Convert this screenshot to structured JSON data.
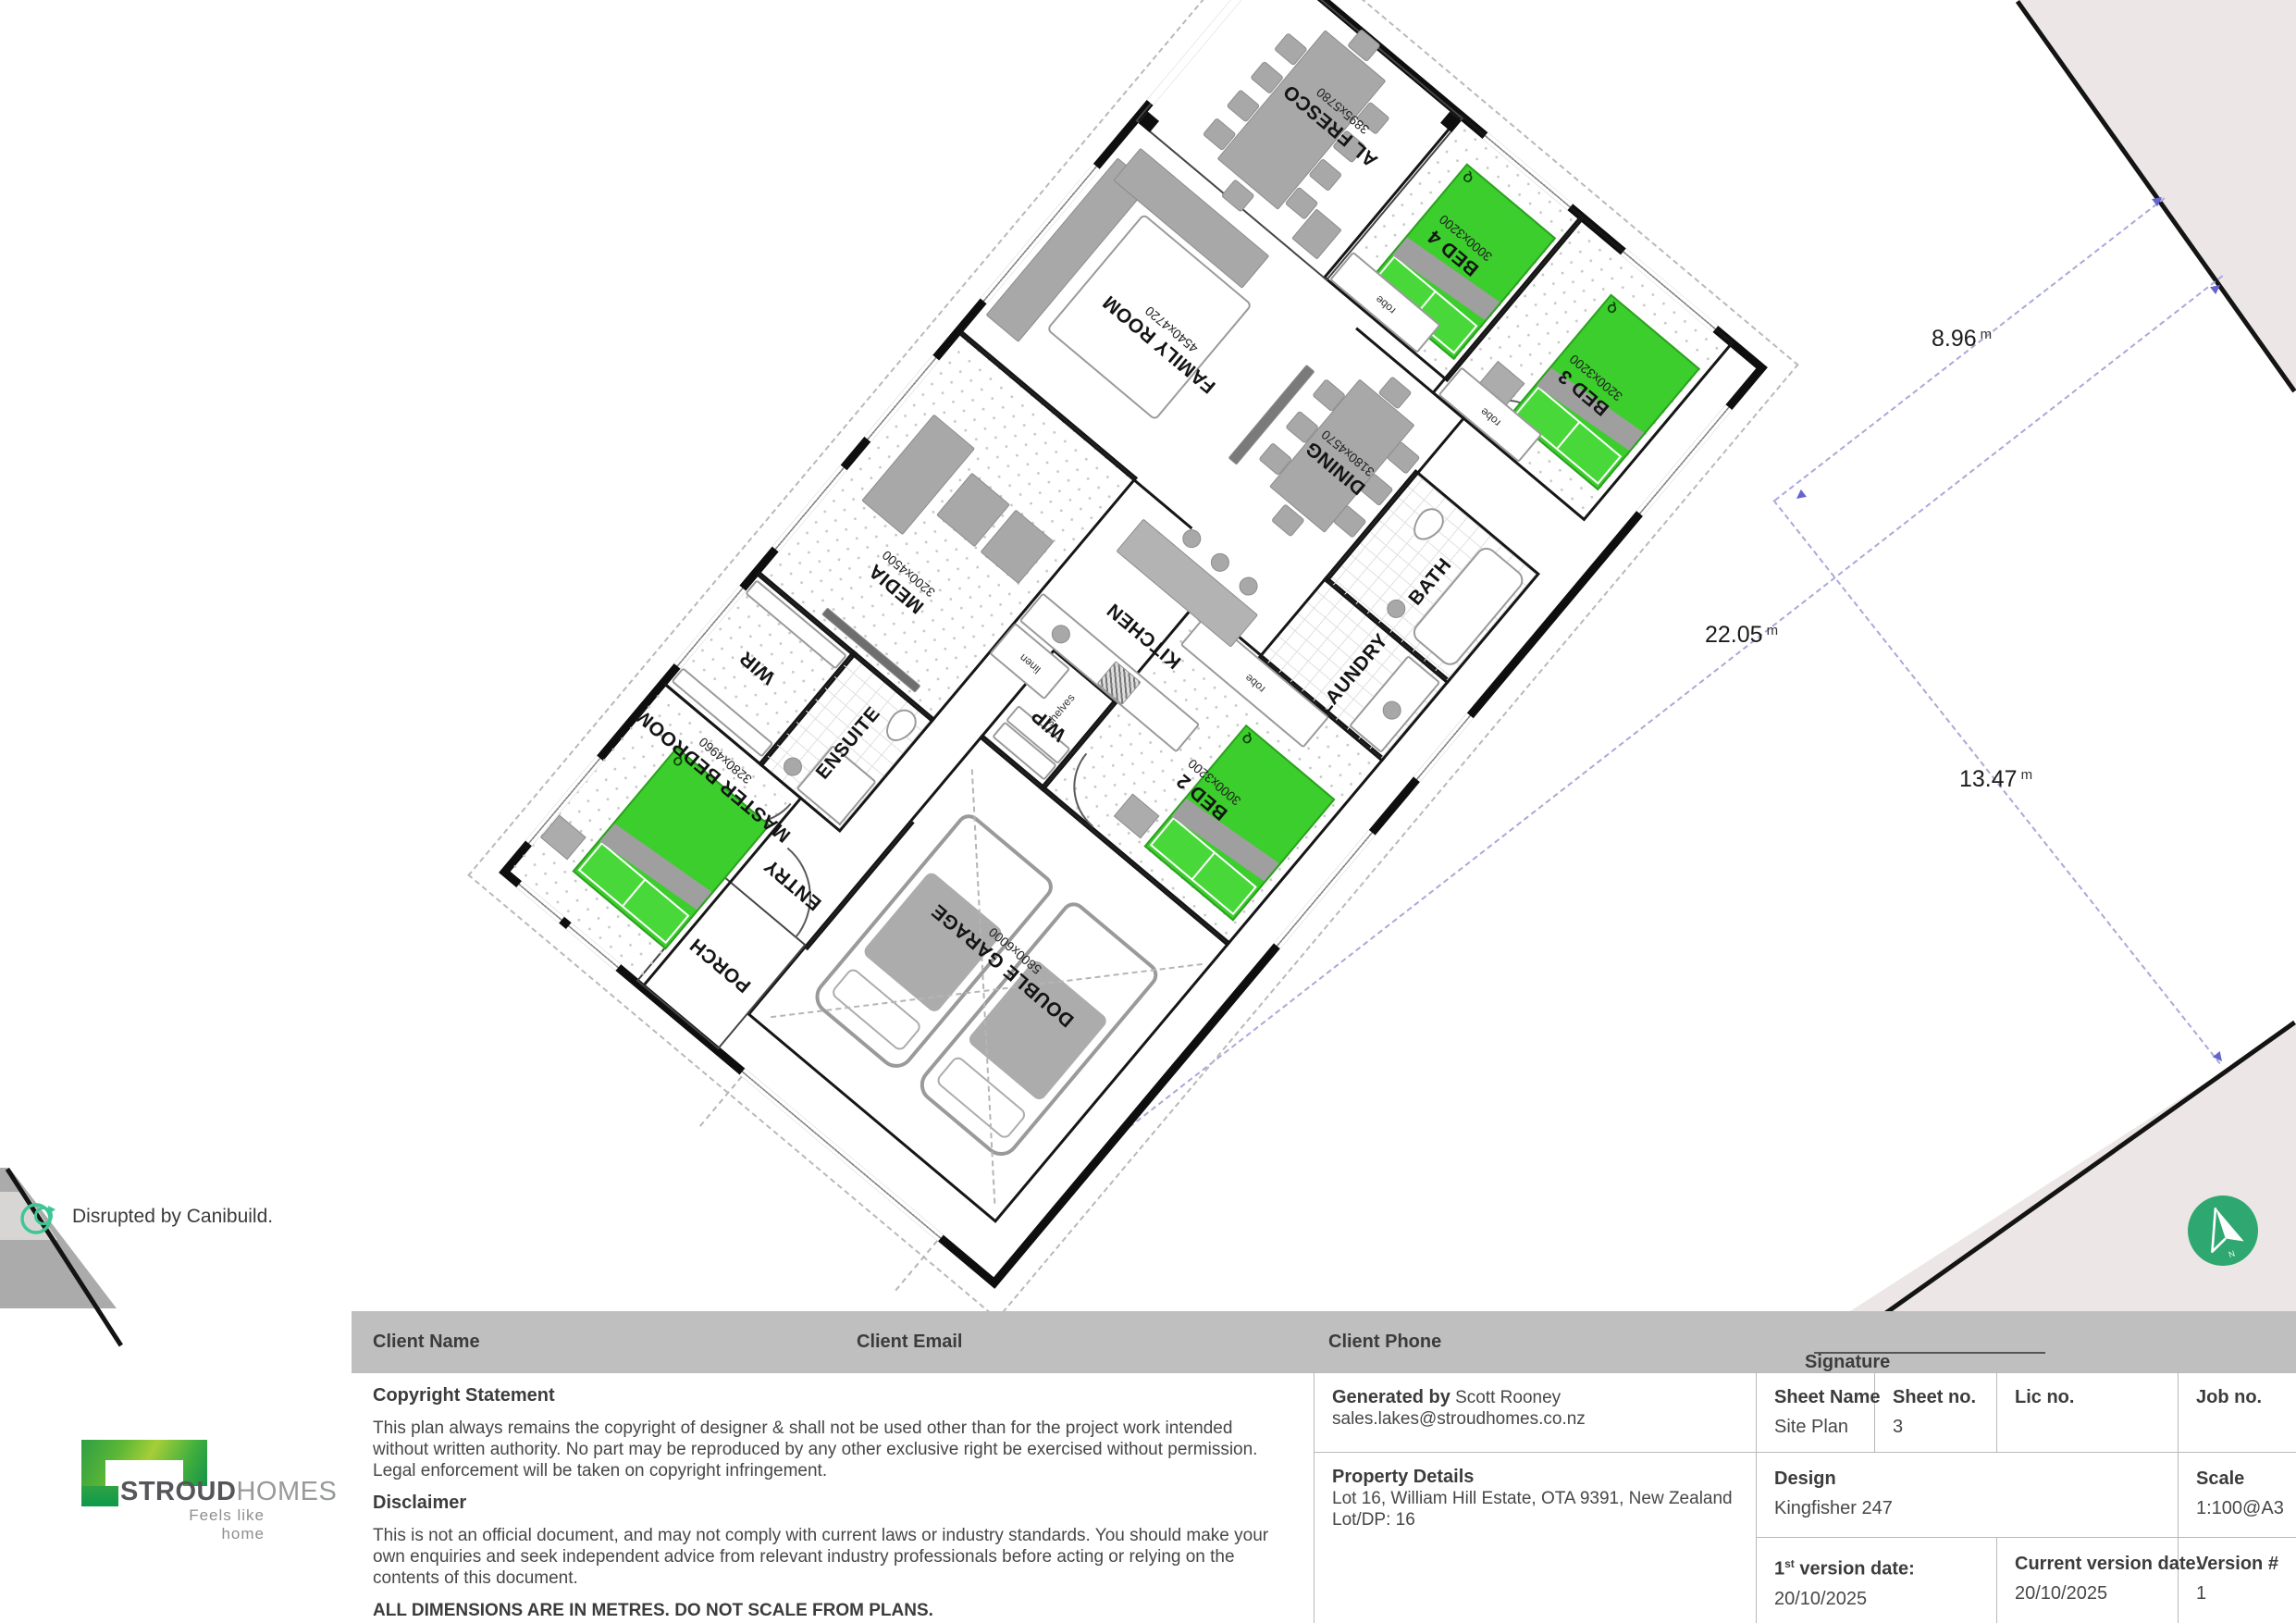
{
  "site": {
    "dimensions": {
      "d1": {
        "value": "8.96",
        "unit": "m"
      },
      "d2": {
        "value": "22.05",
        "unit": "m"
      },
      "d3": {
        "value": "13.47",
        "unit": "m"
      }
    }
  },
  "plan": {
    "rooms": {
      "alfresco": {
        "label": "AL FRESCO",
        "size": "3895x5780"
      },
      "bed4": {
        "label": "BED 4",
        "size": "3000x3200"
      },
      "bed3": {
        "label": "BED 3",
        "size": "3200x3200"
      },
      "bed2": {
        "label": "BED 2",
        "size": "3000x3200"
      },
      "family": {
        "label": "FAMILY ROOM",
        "size": "4540x4720"
      },
      "dining": {
        "label": "DINING",
        "size": "3180x4570"
      },
      "kitchen": {
        "label": "KITCHEN",
        "size": ""
      },
      "media": {
        "label": "MEDIA",
        "size": "3200x4500"
      },
      "master": {
        "label": "MASTER BEDROOM",
        "size": "3280x4960"
      },
      "wir": {
        "label": "WIR",
        "size": ""
      },
      "ensuite": {
        "label": "ENSUITE",
        "size": ""
      },
      "entry": {
        "label": "ENTRY",
        "size": ""
      },
      "porch": {
        "label": "PORCH",
        "size": ""
      },
      "garage": {
        "label": "DOUBLE GARAGE",
        "size": "5800x6000"
      },
      "laundry": {
        "label": "LAUNDRY",
        "size": ""
      },
      "bath": {
        "label": "BATH",
        "size": ""
      },
      "wip": {
        "label": "WIP",
        "size": ""
      }
    },
    "micro": {
      "robe": "robe",
      "linen": "linen",
      "shelves": "shelves",
      "q": "Q"
    }
  },
  "branding": {
    "canibuild_text": "Disrupted by Canibuild.",
    "stroud": "STROUD",
    "homes": "HOMES",
    "tagline": "Feels like home",
    "compass_n": "N"
  },
  "titleblock": {
    "client_name": "Client Name",
    "client_email": "Client Email",
    "client_phone": "Client Phone",
    "signature": "Signature",
    "copyright_heading": "Copyright Statement",
    "copyright_body": "This plan always remains the copyright of designer & shall not be used other than for the project work intended without written authority. No part may be reproduced by any other exclusive right be exercised without permission. Legal enforcement will be taken on copyright infringement.",
    "disclaimer_heading": "Disclaimer",
    "disclaimer_body": "This is not an official document, and may not comply with current laws or industry standards. You should make your own enquiries and seek independent advice from relevant industry professionals before acting or relying on the contents of this document.",
    "all_dims": "ALL DIMENSIONS ARE IN METRES. DO NOT SCALE FROM PLANS.",
    "generated_by_label": "Generated by",
    "generated_by_value": "Scott Rooney",
    "generated_email": "sales.lakes@stroudhomes.co.nz",
    "property_heading": "Property Details",
    "property_address": "Lot 16, William Hill Estate, OTA 9391, New Zealand",
    "property_lot": "Lot/DP: 16",
    "sheet_name_label": "Sheet Name",
    "sheet_name_value": "Site Plan",
    "sheet_no_label": "Sheet no.",
    "sheet_no_value": "3",
    "lic_no_label": "Lic no.",
    "job_no_label": "Job no.",
    "design_label": "Design",
    "design_value": "Kingfisher 247",
    "scale_label": "Scale",
    "scale_value": "1:100@A3",
    "v1_pre": "1",
    "v1_sup": "st",
    "v1_post": " version date:",
    "v1_date": "20/10/2025",
    "cur_label": "Current version date:",
    "cur_date": "20/10/2025",
    "ver_label": "Version #",
    "ver_value": "1"
  }
}
